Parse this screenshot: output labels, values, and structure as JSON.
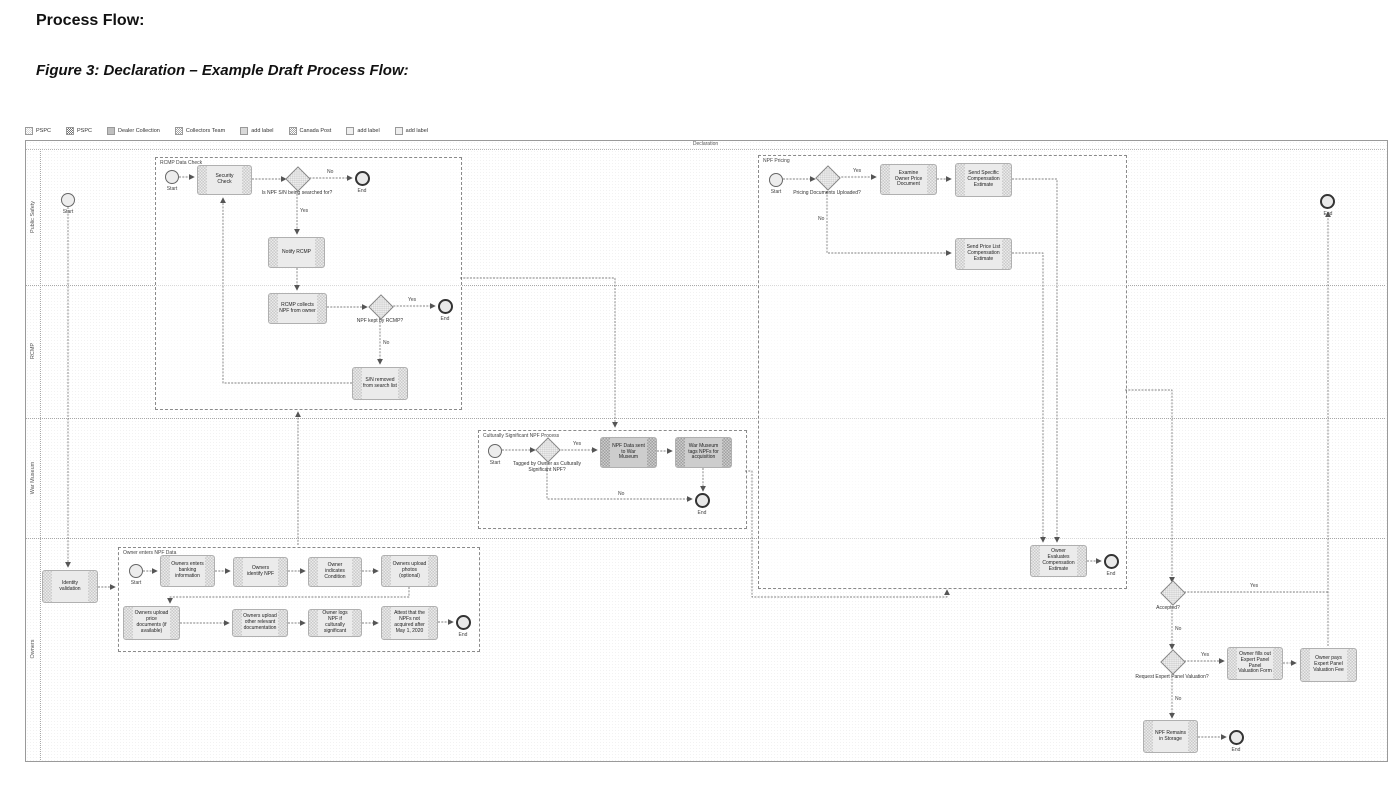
{
  "page": {
    "title": "Process Flow:",
    "figure_caption": "Figure 3: Declaration – Example Draft Process Flow:"
  },
  "legend": {
    "items": [
      {
        "icon": "checker-light-swatch-icon",
        "label": "PSPC"
      },
      {
        "icon": "checker-dark-swatch-icon",
        "label": "PSPC"
      },
      {
        "icon": "solid-gray-swatch-icon",
        "label": "Dealer Collection"
      },
      {
        "icon": "checker-mid-swatch-icon",
        "label": "Collectors Team"
      },
      {
        "icon": "solid-light-swatch-icon",
        "label": "add label"
      },
      {
        "icon": "checker-mid-swatch-icon",
        "label": "Canada Post"
      },
      {
        "icon": "dotted-light-swatch-icon",
        "label": "add label"
      },
      {
        "icon": "dotted-light-swatch-icon",
        "label": "add label"
      }
    ]
  },
  "pool": {
    "title": "Declaration",
    "lanes": [
      "Public Safety",
      "RCMP",
      "War Museum",
      "Owners"
    ]
  },
  "labels": {
    "yes": "Yes",
    "no": "No",
    "start": "Start",
    "end": "End"
  },
  "subprocesses": {
    "rcmp": "RCMP Data Check",
    "pricing": "NPF Pricing",
    "cultural": "Culturally Significant NPF Process",
    "owner": "Owner enters NPF Data"
  },
  "nodes": {
    "identity_validation": "Identity validation",
    "security_check": "Security Check",
    "gw_sn_search": "Is NPF S/N being searched for?",
    "notify_rcmp": "Notify RCMP",
    "rcmp_collects": "RCMP collects NPF from owner",
    "gw_npf_kept": "NPF kept by RCMP?",
    "sn_removed": "S/N removed from search list",
    "gw_pricing_docs": "Pricing Documents Uploaded?",
    "examine_owner_price": "Examine Owner Price Document",
    "send_specific": "Send Specific Compensation Estimate",
    "send_price_list": "Send Price List Compensation Estimate",
    "owner_evaluates": "Owner Evaluates Compensation Estimate",
    "gw_tagged": "Tagged by Owner as Culturally Significant NPF?",
    "npf_sent_museum": "NPF Data sent to War Museum",
    "museum_tags": "War Museum tags NPFs for acquisition",
    "owner_banking": "Owners enters banking information",
    "owner_identify": "Owners identify NPF",
    "owner_condition": "Owner indicates Condition",
    "owner_photos": "Owners upload photos (optional)",
    "owner_price_docs": "Owners upload price documents (if available)",
    "owner_other_docs": "Owners upload other relevant documentation",
    "owner_logs": "Owner logs NPF if culturally significant",
    "owner_attest": "Attest that the NPFs not acquired after May 1, 2020",
    "gw_accepted": "Accepted?",
    "gw_request_panel": "Request Expert Panel Valuation?",
    "owner_fills_form": "Owner fills out Expert Panel Panel Valuation Form",
    "owner_pays_fee": "Owner pays Expert Panel Valuation Fee",
    "npf_storage": "NPF Remains in Storage"
  }
}
